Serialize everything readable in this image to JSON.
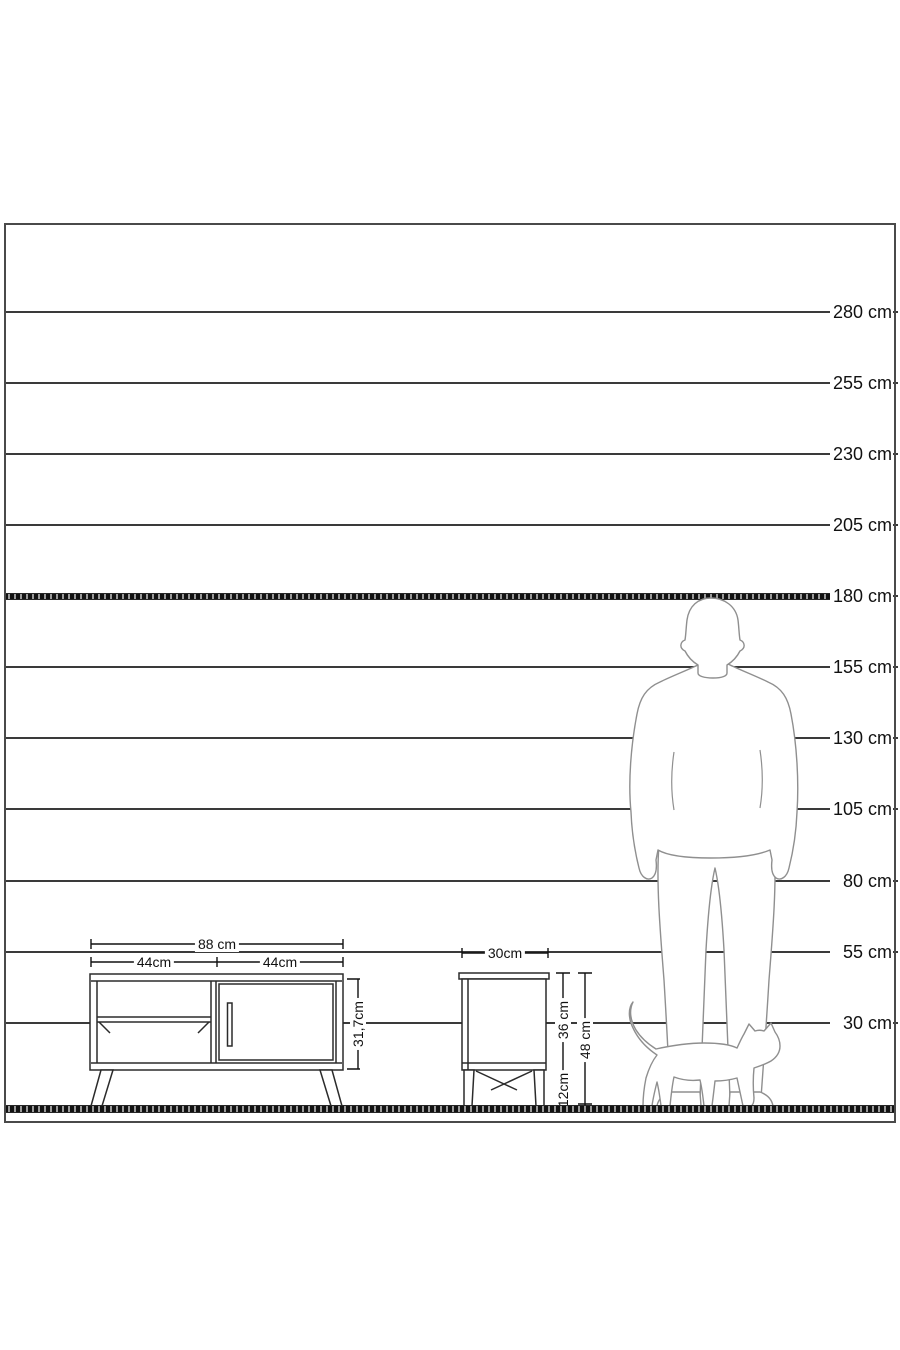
{
  "title": "furniture-height-scale-diagram",
  "scale": {
    "unit": "cm",
    "values_cm": [
      280,
      255,
      230,
      205,
      180,
      155,
      130,
      105,
      80,
      55,
      30
    ],
    "labels": [
      "280 cm",
      "255 cm",
      "230 cm",
      "205 cm",
      "180 cm",
      "155 cm",
      "130 cm",
      "105 cm",
      "80 cm",
      "55 cm",
      "30 cm"
    ],
    "highlight_value_cm": 180
  },
  "tv_stand": {
    "width_total_label": "88 cm",
    "width_left_label": "44cm",
    "width_right_label": "44cm",
    "height_label": "31,7cm"
  },
  "nightstand": {
    "width_label": "30cm",
    "body_height_label": "36 cm",
    "total_height_label": "48 cm",
    "leg_height_label": "12cm"
  },
  "figures": {
    "person": "standing-man-silhouette",
    "cat": "walking-cat-silhouette"
  },
  "colors": {
    "background": "#ffffff",
    "line": "#3a3a3a",
    "frame": "#4a4a4a",
    "silhouette": "#8f8f8f",
    "furniture_line": "#2b2b2b",
    "dimension_line": "#101010",
    "text": "#111111"
  }
}
